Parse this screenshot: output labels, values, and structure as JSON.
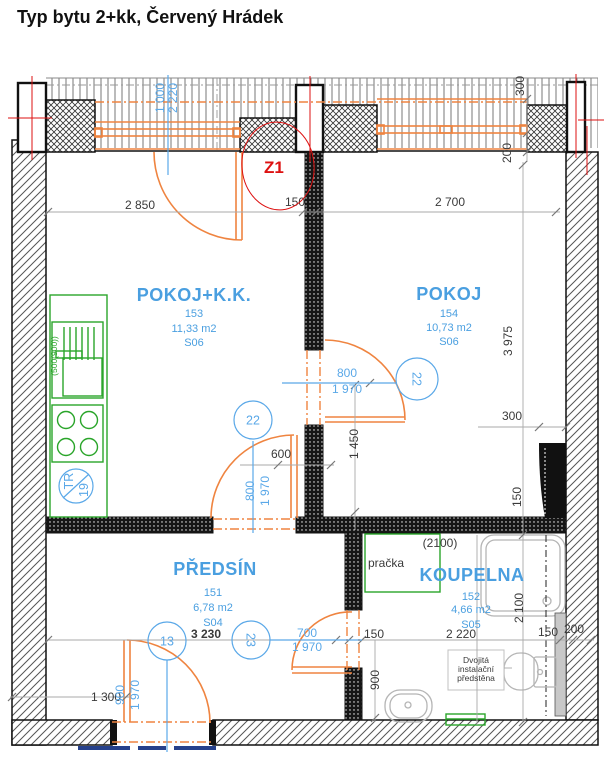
{
  "title": "Typ bytu 2+kk, Červený Hrádek",
  "marker": {
    "label": "Z1"
  },
  "rooms": [
    {
      "name": "POKOJ+K.K.",
      "number": "153",
      "area": "11,33 m2",
      "section": "S06"
    },
    {
      "name": "POKOJ",
      "number": "154",
      "area": "10,73 m2",
      "section": "S06"
    },
    {
      "name": "PŘEDSÍN",
      "number": "151",
      "area": "6,78 m2",
      "section": "S04"
    },
    {
      "name": "KOUPELNA",
      "number": "152",
      "area": "4,66 m2",
      "section": "S05"
    }
  ],
  "doors": {
    "pokoj": {
      "mark": "22",
      "size_w": "800",
      "size_h": "1 970"
    },
    "kk": {
      "mark": "22",
      "size_w": "800",
      "size_h": "1 970"
    },
    "bath": {
      "mark": "23",
      "size_w": "700",
      "size_h": "1 970"
    },
    "entry": {
      "mark": "13",
      "size_w": "900",
      "size_h": "1 970"
    },
    "balcony": {
      "size_w": "1 000",
      "size_h": "2 220"
    }
  },
  "dims": {
    "kk_width": "2 850",
    "mid_wall": "150",
    "pokoj_width": "2 700",
    "top_300": "300",
    "top_200": "200",
    "pokoj_height": "3 975",
    "shaft_300": "300",
    "shaft_150": "150",
    "mid_1450": "1 450",
    "mid_600": "600",
    "hall_width": "3 230",
    "door_wall_150": "150",
    "bath_width": "2 220",
    "bath_150": "150",
    "bath_200": "200",
    "bath_height": "2 100",
    "bath_900": "900",
    "entry_1300": "1 300",
    "bath_head": "(2100)"
  },
  "kitchen": {
    "sink_label": "(500(900))",
    "tr_label": "TR",
    "tr_value": "19"
  },
  "bath": {
    "washer": "pračka",
    "note_line1": "Dvojitá",
    "note_line2": "instalační",
    "note_line3": "předstěna"
  },
  "colors": {
    "room_blue": "#4a9fe0",
    "dim_blue": "#5aa8e8",
    "dim_dark": "#3a3a3a",
    "door_orange": "#ef8440",
    "fixture_green": "#2aa52a",
    "marker_red": "#dd1111",
    "wall_black": "#111111"
  }
}
